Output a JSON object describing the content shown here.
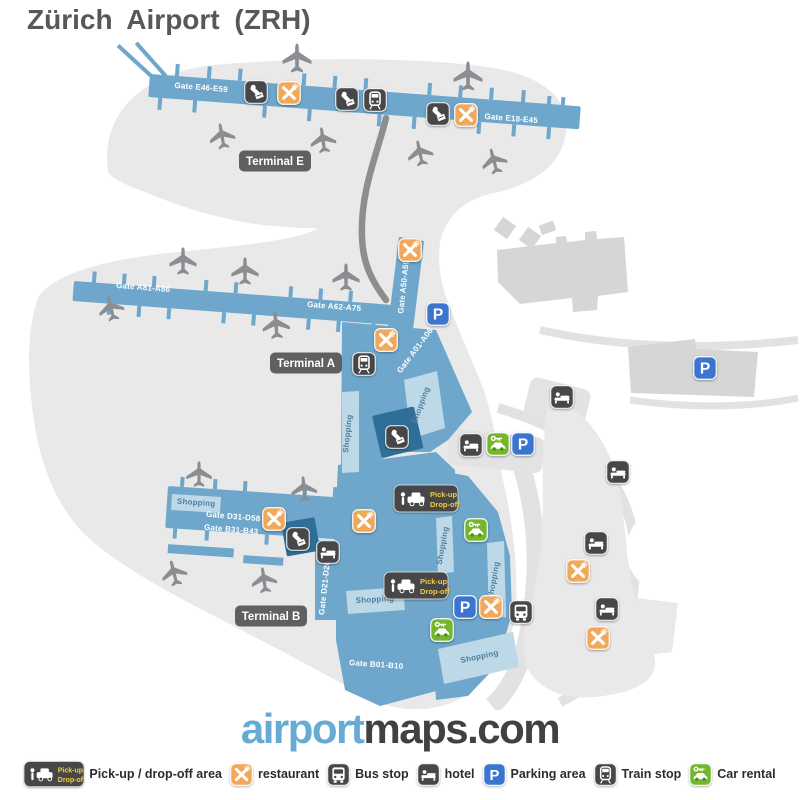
{
  "title": "Zürich Airport (ZRH)",
  "logo": {
    "part1": "airport",
    "part2": "maps.com"
  },
  "colors": {
    "title": "#58585a",
    "blue": "#6ea7cb",
    "lightblue": "#bdd9e8",
    "darkblue": "#2f6f97",
    "gray_blob": "#e9e9ea",
    "gray_building": "#d6d6d7",
    "icon_dark": "#474749",
    "restaurant": "#f1a85b",
    "parking": "#3c75cf",
    "green": "#74b62c",
    "badge": "#59595c",
    "road_dark": "#8e8e8e",
    "road_light": "#e2e2e3",
    "plane": "#8b8e91",
    "yellow": "#f2cf3c",
    "logo_blue": "#66abd4",
    "logo_dark": "#414144",
    "legend_text": "#2a2c2e",
    "shopping_text": "#4f7e9e"
  },
  "map": {
    "terminal_badges": [
      {
        "label": "Terminal E",
        "x": 275,
        "y": 161
      },
      {
        "label": "Terminal A",
        "x": 306,
        "y": 363
      },
      {
        "label": "Terminal B",
        "x": 271,
        "y": 616
      }
    ],
    "gate_labels": [
      {
        "label": "Gate E46-E59",
        "x": 201,
        "y": 90,
        "rot": 4.5
      },
      {
        "label": "Gate E18-E45",
        "x": 511,
        "y": 121,
        "rot": 4.5
      },
      {
        "label": "Gate A81-A86",
        "x": 143,
        "y": 290,
        "rot": 4.5
      },
      {
        "label": "Gate A62-A75",
        "x": 334,
        "y": 309,
        "rot": 4.5
      },
      {
        "label": "Gate A50-A59",
        "x": 406,
        "y": 287,
        "rot": -84
      },
      {
        "label": "Gate A01-A06",
        "x": 417,
        "y": 352,
        "rot": -53
      },
      {
        "label": "Gate D31-D58",
        "x": 233,
        "y": 519,
        "rot": 5
      },
      {
        "label": "Gate B31-B43",
        "x": 231,
        "y": 532,
        "rot": 5
      },
      {
        "label": "Gate D21-D26",
        "x": 327,
        "y": 588,
        "rot": -84
      },
      {
        "label": "Gate B01-B10",
        "x": 376,
        "y": 667,
        "rot": 4
      }
    ],
    "shopping_labels": [
      {
        "label": "Shopping",
        "x": 350,
        "y": 434,
        "rot": -84
      },
      {
        "label": "Shopping",
        "x": 423,
        "y": 406,
        "rot": -70
      },
      {
        "label": "Shopping",
        "x": 196,
        "y": 505,
        "rot": 4
      },
      {
        "label": "Shopping",
        "x": 375,
        "y": 602,
        "rot": -3
      },
      {
        "label": "Shopping",
        "x": 480,
        "y": 659,
        "rot": -12
      },
      {
        "label": "Shopping",
        "x": 445,
        "y": 546,
        "rot": -80
      },
      {
        "label": "Shopping",
        "x": 496,
        "y": 581,
        "rot": -80
      }
    ],
    "pickup_badge": {
      "line1": "Pick-up",
      "line2": "Drop-off"
    },
    "pickup_badges": [
      {
        "x": 394,
        "y": 485
      },
      {
        "x": 384,
        "y": 572
      }
    ],
    "markers": [
      {
        "type": "passport",
        "x": 256,
        "y": 92
      },
      {
        "type": "passport",
        "x": 347,
        "y": 99
      },
      {
        "type": "passport",
        "x": 438,
        "y": 114
      },
      {
        "type": "passport",
        "x": 397,
        "y": 437
      },
      {
        "type": "passport",
        "x": 298,
        "y": 539
      },
      {
        "type": "restaurant",
        "x": 289,
        "y": 93
      },
      {
        "type": "restaurant",
        "x": 466,
        "y": 115
      },
      {
        "type": "restaurant",
        "x": 410,
        "y": 250
      },
      {
        "type": "restaurant",
        "x": 386,
        "y": 340
      },
      {
        "type": "restaurant",
        "x": 274,
        "y": 519
      },
      {
        "type": "restaurant",
        "x": 364,
        "y": 521
      },
      {
        "type": "restaurant",
        "x": 491,
        "y": 607
      },
      {
        "type": "restaurant",
        "x": 578,
        "y": 571
      },
      {
        "type": "restaurant",
        "x": 598,
        "y": 638
      },
      {
        "type": "train",
        "x": 375,
        "y": 100
      },
      {
        "type": "train",
        "x": 364,
        "y": 364
      },
      {
        "type": "parking",
        "x": 438,
        "y": 314
      },
      {
        "type": "parking",
        "x": 523,
        "y": 444
      },
      {
        "type": "parking",
        "x": 465,
        "y": 607
      },
      {
        "type": "parking",
        "x": 705,
        "y": 368
      },
      {
        "type": "hotel",
        "x": 471,
        "y": 445
      },
      {
        "type": "hotel",
        "x": 562,
        "y": 397
      },
      {
        "type": "hotel",
        "x": 618,
        "y": 472
      },
      {
        "type": "hotel",
        "x": 596,
        "y": 543
      },
      {
        "type": "hotel",
        "x": 607,
        "y": 609
      },
      {
        "type": "hotel",
        "x": 328,
        "y": 552
      },
      {
        "type": "car-rental",
        "x": 498,
        "y": 444
      },
      {
        "type": "car-rental",
        "x": 476,
        "y": 530
      },
      {
        "type": "car-rental",
        "x": 442,
        "y": 630
      },
      {
        "type": "bus",
        "x": 521,
        "y": 612
      }
    ],
    "airplanes": [
      {
        "x": 297,
        "y": 58,
        "rot": 0,
        "s": 34
      },
      {
        "x": 468,
        "y": 76,
        "rot": 0,
        "s": 34
      },
      {
        "x": 222,
        "y": 136,
        "rot": -10,
        "s": 30
      },
      {
        "x": 323,
        "y": 140,
        "rot": -8,
        "s": 30
      },
      {
        "x": 420,
        "y": 153,
        "rot": -12,
        "s": 30
      },
      {
        "x": 494,
        "y": 161,
        "rot": -15,
        "s": 30
      },
      {
        "x": 183,
        "y": 261,
        "rot": 0,
        "s": 32
      },
      {
        "x": 245,
        "y": 271,
        "rot": 0,
        "s": 32
      },
      {
        "x": 346,
        "y": 277,
        "rot": 0,
        "s": 32
      },
      {
        "x": 111,
        "y": 308,
        "rot": -14,
        "s": 30
      },
      {
        "x": 276,
        "y": 325,
        "rot": -5,
        "s": 32
      },
      {
        "x": 199,
        "y": 474,
        "rot": 0,
        "s": 30
      },
      {
        "x": 304,
        "y": 489,
        "rot": -5,
        "s": 30
      },
      {
        "x": 174,
        "y": 573,
        "rot": -14,
        "s": 30
      },
      {
        "x": 264,
        "y": 580,
        "rot": -8,
        "s": 30
      }
    ]
  },
  "legend": [
    {
      "type": "pickup",
      "label": "Pick-up / drop-off area"
    },
    {
      "type": "restaurant",
      "label": "restaurant"
    },
    {
      "type": "bus",
      "label": "Bus stop"
    },
    {
      "type": "hotel",
      "label": "hotel"
    },
    {
      "type": "parking",
      "label": "Parking area"
    },
    {
      "type": "train",
      "label": "Train stop"
    },
    {
      "type": "car-rental",
      "label": "Car rental"
    }
  ]
}
